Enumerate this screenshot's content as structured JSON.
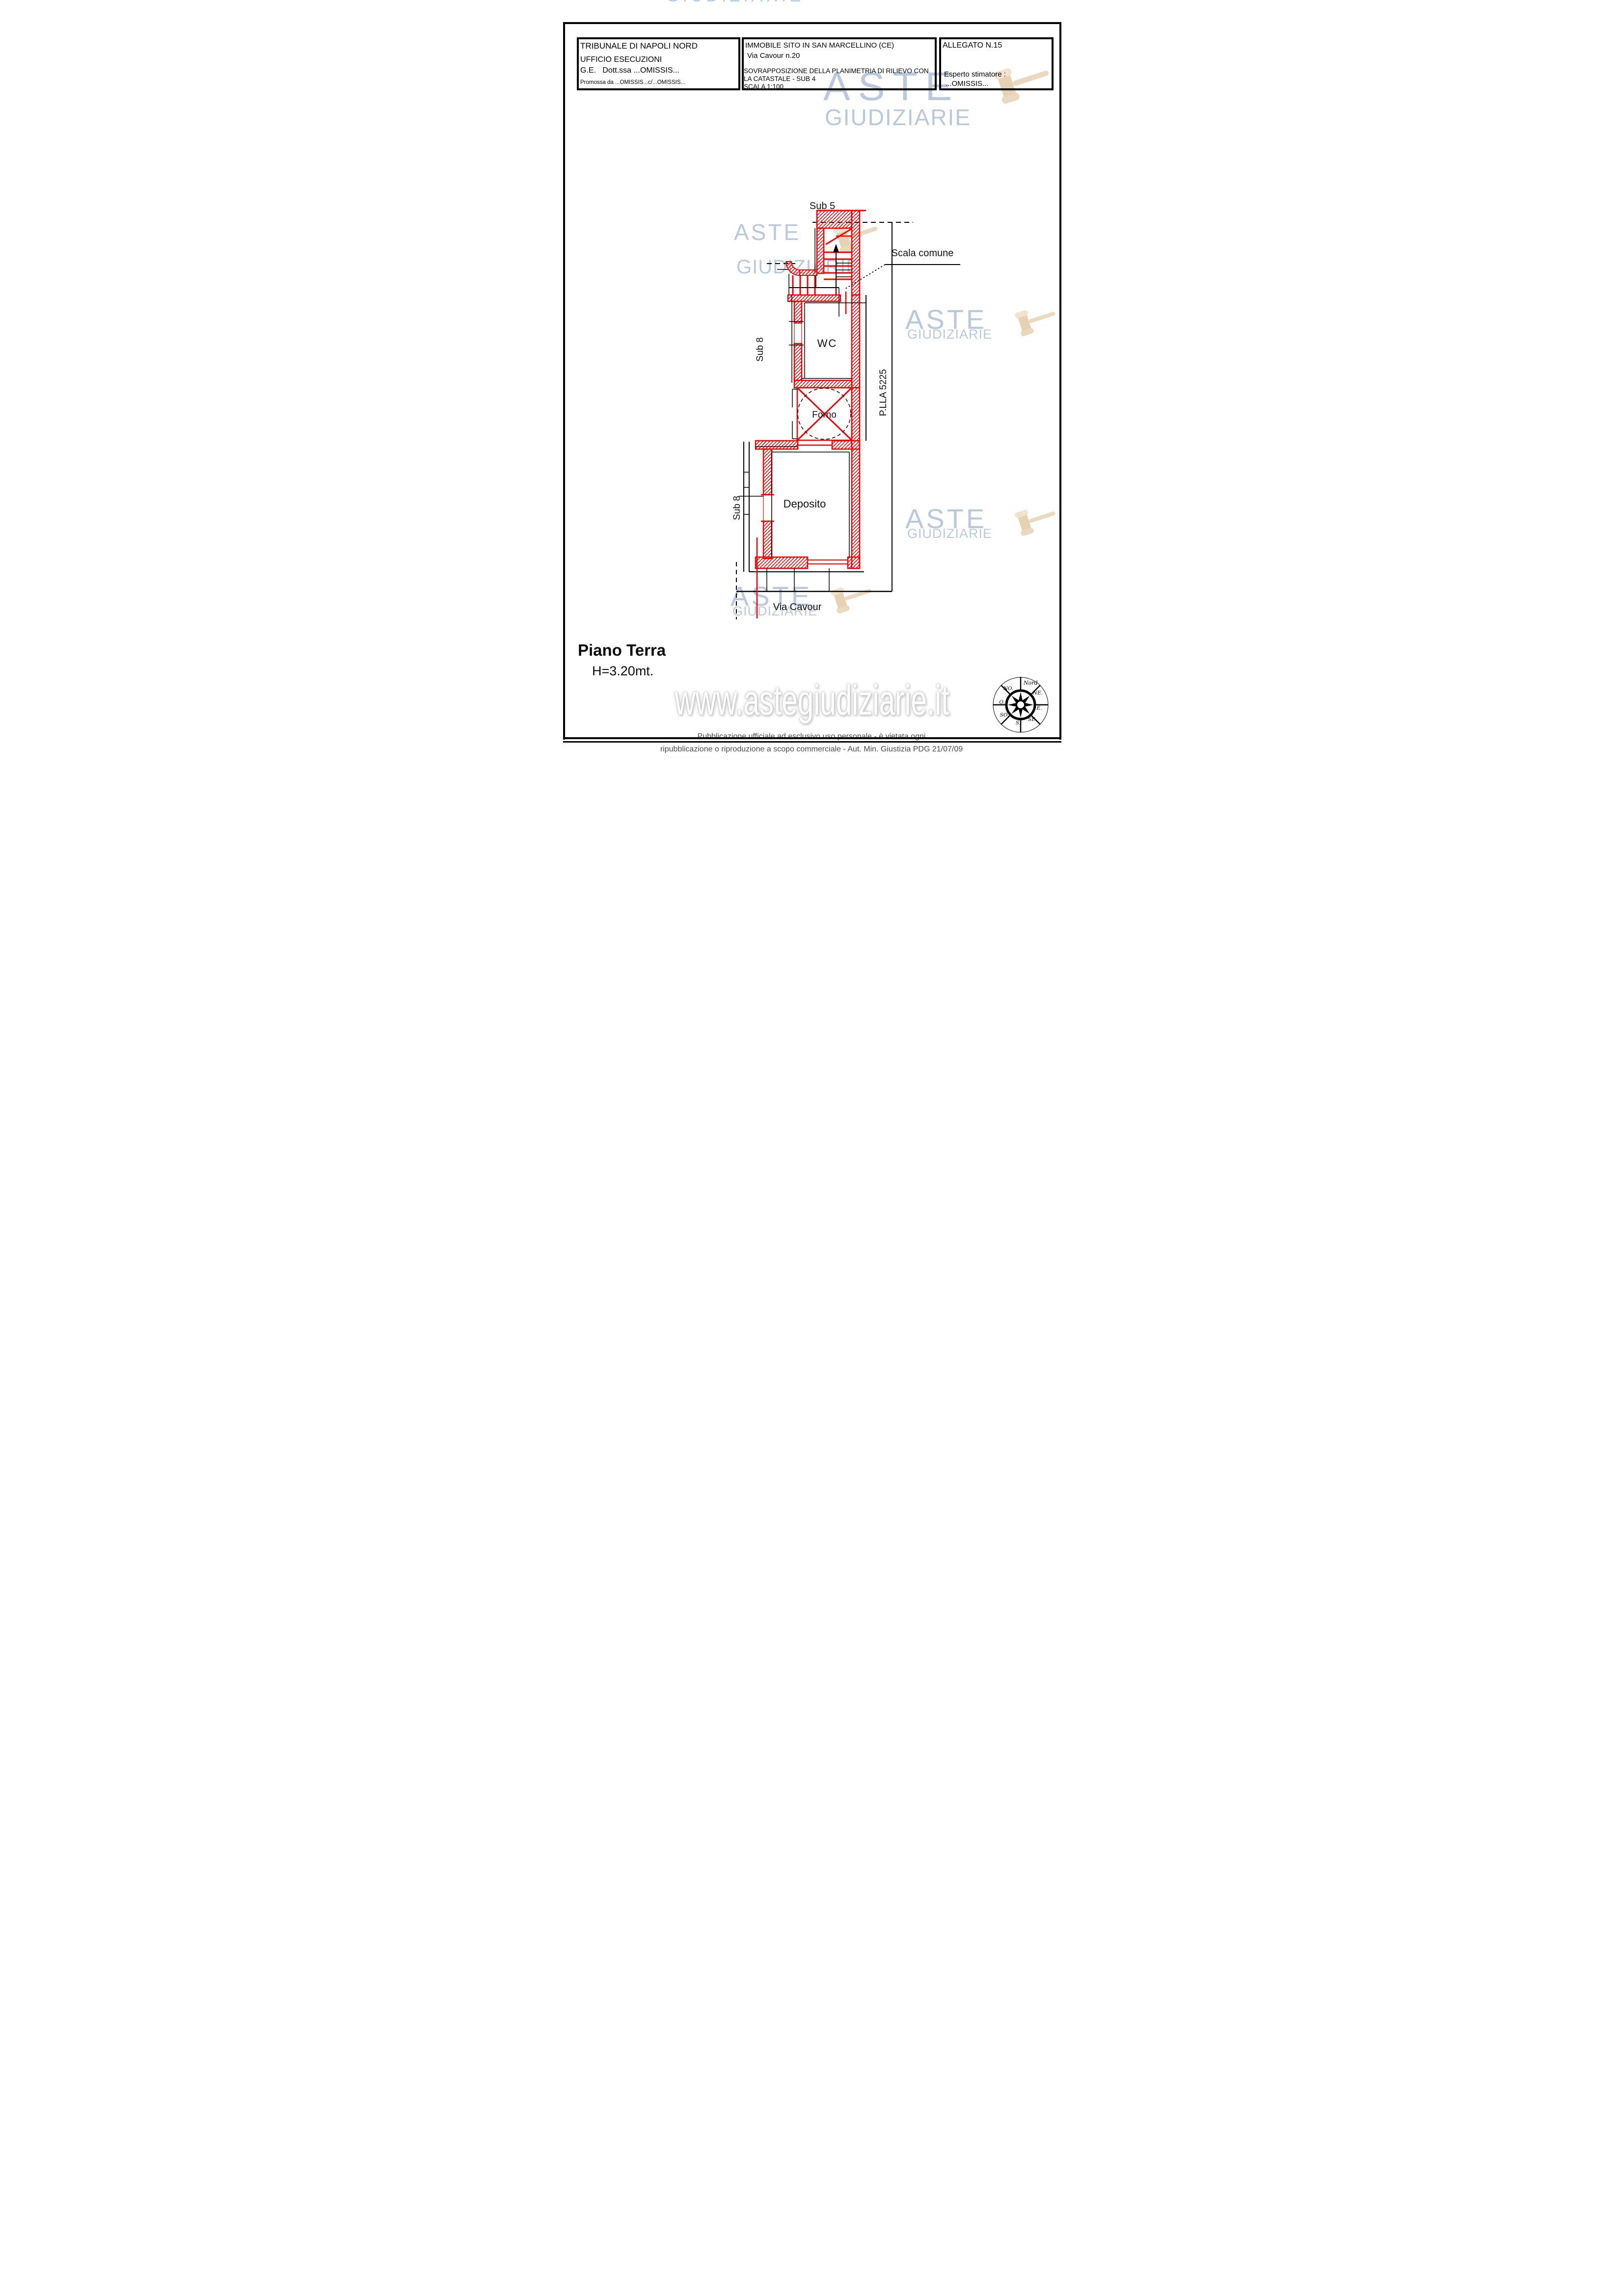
{
  "header": {
    "court": {
      "title": "TRIBUNALE DI NAPOLI NORD",
      "office": "UFFICIO ESECUZIONI",
      "judge": "G.E.   Dott.ssa ...OMISSIS...",
      "promoted_by": "Promossa da ...OMISSIS...c/...OMISSIS..."
    },
    "property": {
      "location": "IMMOBILE SITO IN SAN MARCELLINO (CE)",
      "address": "Via Cavour n.20",
      "description_line1": "SOVRAPPOSIZIONE DELLA PLANIMETRIA DI RILIEVO CON",
      "description_line2": "LA CATASTALE - SUB 4",
      "scale": "SCALA 1:100"
    },
    "attachment": {
      "number": "ALLEGATO N.15",
      "expert_label": "Esperto stimatore :",
      "expert_name": "...OMISSIS..."
    }
  },
  "plan": {
    "labels": {
      "sub5": "Sub 5",
      "scala_comune": "Scala comune",
      "wc": "WC",
      "sub8_upper": "Sub 8",
      "forno": "Forno",
      "parcel": "P.LLA 5225",
      "sub8_lower": "Sub 8",
      "deposito": "Deposito",
      "street": "Via Cavour"
    },
    "wall_color": "#f40000",
    "line_color": "#000000"
  },
  "floor_title": {
    "name": "Piano Terra",
    "height": "H=3.20mt."
  },
  "compass": {
    "north": "Nord",
    "nw": "NO.",
    "ne": "NE.",
    "west": "O.",
    "east": "E.",
    "sw": "SO.",
    "se": "SE.",
    "south": "S."
  },
  "watermark": {
    "brand_line1": "ASTE",
    "brand_line2": "GIUDIZIARIE",
    "url": "www.astegiudiziarie.it",
    "text_color": "#a9bbd6",
    "gavel_color": "#e7d2b4"
  },
  "footer": {
    "line1": "Pubblicazione ufficiale ad esclusivo uso personale - è vietata ogni",
    "line2": "ripubblicazione o riproduzione a scopo commerciale - Aut. Min. Giustizia PDG 21/07/09"
  }
}
